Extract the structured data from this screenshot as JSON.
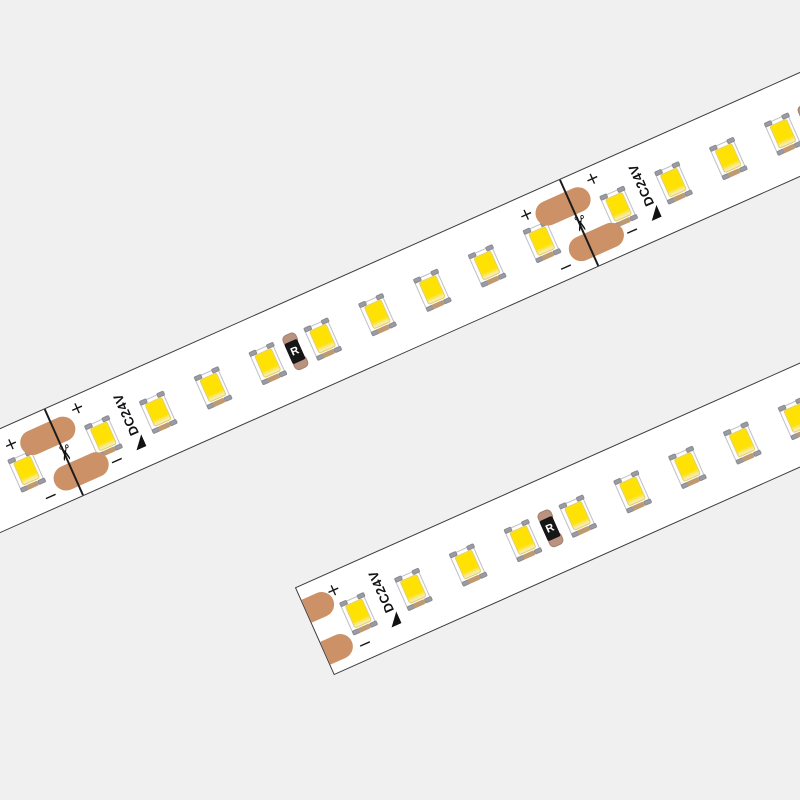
{
  "canvas": {
    "width": 800,
    "height": 800,
    "background": "#f0f0f1"
  },
  "labels": {
    "voltage": "DC24V",
    "resistor": "R",
    "plus": "+",
    "minus": "−",
    "scissors_icon": "✂"
  },
  "colors": {
    "background": "#f0f0f1",
    "strip_fill": "#ffffff",
    "strip_border": "#3c3c3c",
    "solder_pad_copper": "#cc9166",
    "led_yellow": "#ffe103",
    "led_yellow_pale": "#f6ecb4",
    "led_frame_gray": "#bfbfc7",
    "led_tab_gray": "#9b9ba3",
    "led_tab_copper": "#bf9a71",
    "resistor_body": "#161616",
    "resistor_cap": "#b99380",
    "cut_line": "#1c1c1c",
    "symbol_ink": "#161616"
  },
  "strips": [
    {
      "name": "led-strip-upper",
      "left": -185,
      "top": 259,
      "length": 1150,
      "width": 96,
      "angle": -24,
      "end_cut": false,
      "cuts": [
        217,
        781
      ],
      "leds": [
        55,
        115,
        175,
        259,
        319,
        379,
        439,
        499,
        559,
        619,
        679,
        739,
        823,
        883,
        943,
        1003,
        1063,
        1123
      ],
      "voltage_labels": [
        289,
        853
      ],
      "resistors": [
        469,
        1033
      ]
    },
    {
      "name": "led-strip-lower",
      "left": 285,
      "top": 445,
      "length": 680,
      "width": 96,
      "angle": -24,
      "end_cut": true,
      "cuts": [
        624
      ],
      "leds": [
        46,
        106,
        166,
        226,
        286,
        346,
        406,
        466,
        526,
        586,
        646
      ],
      "voltage_labels": [
        76
      ],
      "resistors": [
        256
      ]
    }
  ]
}
